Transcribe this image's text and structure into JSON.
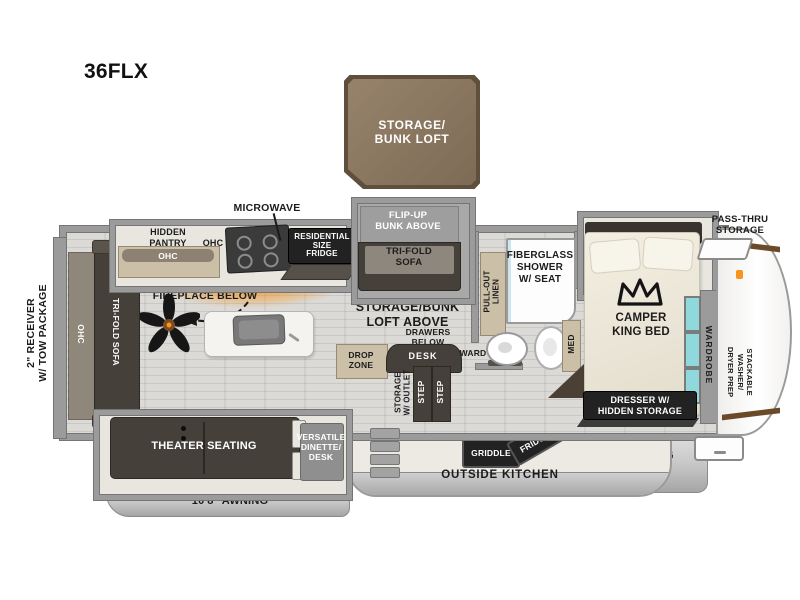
{
  "model": "36FLX",
  "colors": {
    "loft_brown": "#8a7660",
    "loft_border": "#5f4f3c",
    "wall_gray": "#9b9b9b",
    "furniture_dark": "#45403a",
    "cabinet_tan": "#cbbfa7",
    "window_teal": "#8fd8dc",
    "fireplace_orange": "#f7941d",
    "floor_gray": "#d6d5d2"
  },
  "loft": {
    "label": "STORAGE/\nBUNK LOFT"
  },
  "exterior": {
    "receiver": "2\" RECEIVER\nW/ TOW PACKAGE",
    "pass_thru": "PASS-THRU\nSTORAGE",
    "awning_left": "10'8\" AWNING",
    "awning_right": "21' AWNING",
    "outside_kitchen": {
      "title": "OUTSIDE KITCHEN",
      "griddle": "GRIDDLE",
      "fridge": "FRIDGE"
    }
  },
  "kitchen": {
    "microwave": "MICROWAVE",
    "hidden_pantry": "HIDDEN\nPANTRY",
    "pantry_ohc": "OHC",
    "ohc": "OHC",
    "fridge": "RESIDENTIAL\nSIZE\nFRIDGE",
    "tv": "TV W/\nFIREPLACE BELOW"
  },
  "living": {
    "rear_ohc": "OHC",
    "rear_sofa": "TRI-FOLD SOFA",
    "loft_above": "STORAGE/BUNK\nLOFT ABOVE",
    "theater": "THEATER SEATING",
    "dinette": "VERSATILE\nDINETTE/\nDESK"
  },
  "bunk_room": {
    "flip_up": "FLIP-UP\nBUNK ABOVE",
    "sofa": "TRI-FOLD\nSOFA",
    "drawers": "DRAWERS\nBELOW",
    "desk": "DESK",
    "drop_zone": "DROP\nZONE",
    "ward": "WARD",
    "storage_outlet": "STORAGE\nW/ OUTLET",
    "steps": [
      "STEP",
      "STEP"
    ]
  },
  "bath": {
    "linen": "PULL-OUT\nLINEN",
    "shower": "FIBERGLASS\nSHOWER\nW/ SEAT",
    "med": "MED"
  },
  "bedroom": {
    "bed": "CAMPER\nKING BED",
    "wardrobe": "WARDROBE",
    "washer": "STACKABLE\nWASHER/\nDRYER PREP",
    "dresser": "DRESSER W/\nHIDDEN STORAGE"
  }
}
